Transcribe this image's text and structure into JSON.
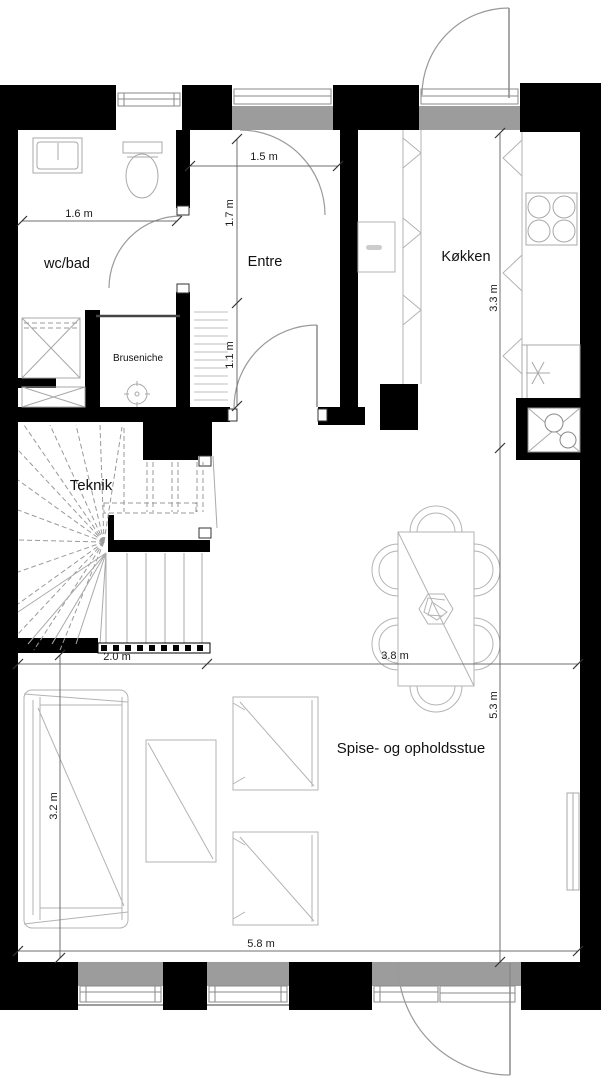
{
  "plan_title": "floor-plan",
  "rooms": {
    "wcbad": {
      "label": "wc/bad"
    },
    "entre": {
      "label": "Entre"
    },
    "kokken": {
      "label": "Køkken"
    },
    "bruseniche": {
      "label": "Bruseniche"
    },
    "teknik": {
      "label": "Teknik"
    },
    "spise": {
      "label": "Spise- og opholdsstue"
    }
  },
  "dims": {
    "d15": {
      "label": "1.5 m"
    },
    "d16": {
      "label": "1.6 m"
    },
    "d17": {
      "label": "1.7 m"
    },
    "d11": {
      "label": "1.1 m"
    },
    "d33": {
      "label": "3.3 m"
    },
    "d20": {
      "label": "2.0 m"
    },
    "d38": {
      "label": "3.8 m"
    },
    "d53": {
      "label": "5.3 m"
    },
    "d32": {
      "label": "3.2 m"
    },
    "d58": {
      "label": "5.8 m"
    }
  },
  "colors": {
    "wall": "#000000",
    "opening_gray": "#9c9c9c",
    "furniture_line": "#b3b3b3",
    "dimension_line": "#6f6f6f",
    "text": "#111111",
    "background": "#ffffff"
  }
}
